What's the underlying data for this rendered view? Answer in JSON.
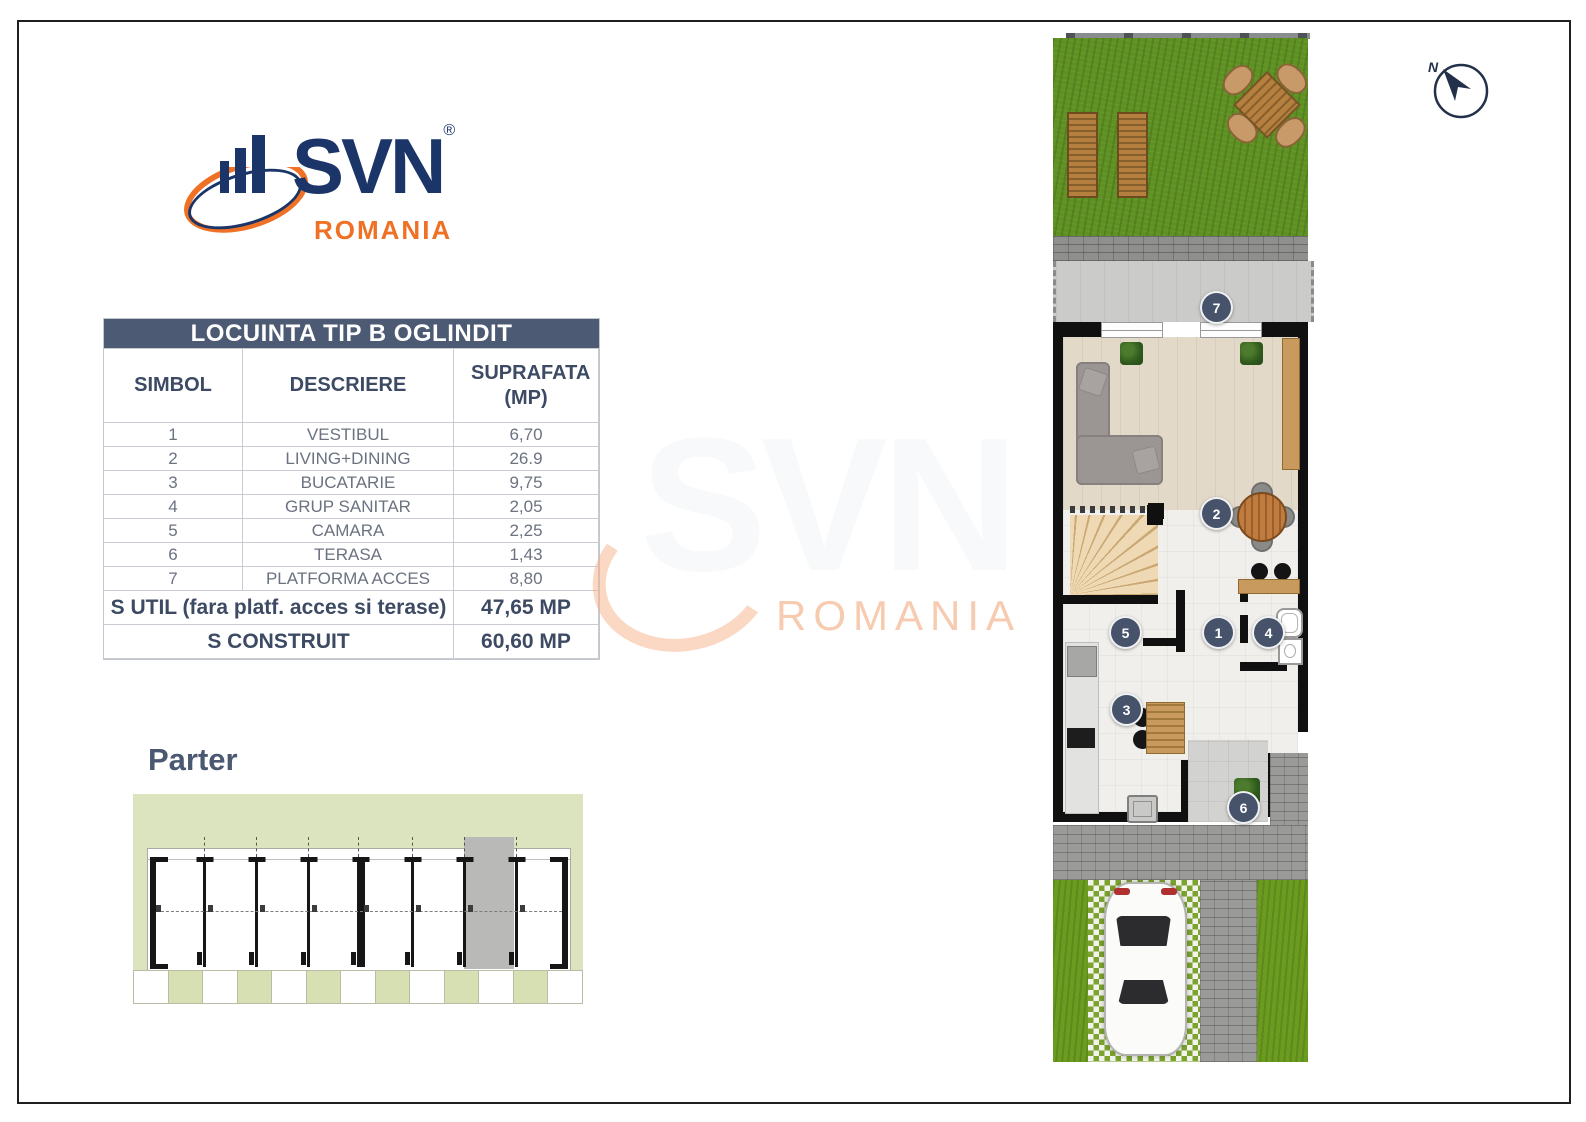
{
  "logo": {
    "brand": "SVN",
    "registered": "®",
    "region": "ROMANIA"
  },
  "compass": {
    "label": "N"
  },
  "table": {
    "title": "LOCUINTA TIP B OGLINDIT",
    "columns": [
      "SIMBOL",
      "DESCRIERE",
      "SUPRAFATA (MP)"
    ],
    "rows": [
      {
        "simbol": "1",
        "descriere": "VESTIBUL",
        "suprafata": "6,70"
      },
      {
        "simbol": "2",
        "descriere": "LIVING+DINING",
        "suprafata": "26.9"
      },
      {
        "simbol": "3",
        "descriere": "BUCATARIE",
        "suprafata": "9,75"
      },
      {
        "simbol": "4",
        "descriere": "GRUP SANITAR",
        "suprafata": "2,05"
      },
      {
        "simbol": "5",
        "descriere": "CAMARA",
        "suprafata": "2,25"
      },
      {
        "simbol": "6",
        "descriere": "TERASA",
        "suprafata": "1,43"
      },
      {
        "simbol": "7",
        "descriere": "PLATFORMA ACCES",
        "suprafata": "8,80"
      }
    ],
    "summary": [
      {
        "label": "S UTIL (fara platf. acces si terase)",
        "value": "47,65 MP"
      },
      {
        "label": "S CONSTRUIT",
        "value": "60,60 MP"
      }
    ]
  },
  "floor": {
    "label": "Parter"
  },
  "watermark": {
    "brand": "SVN",
    "region": "ROMANIA"
  },
  "plan": {
    "markers": [
      "1",
      "2",
      "3",
      "4",
      "5",
      "6",
      "7"
    ]
  },
  "colors": {
    "brand_navy": "#1c3569",
    "brand_orange": "#ef7125",
    "slate": "#4d5a74",
    "marker": "#46536b",
    "grass": "#5e9122"
  }
}
